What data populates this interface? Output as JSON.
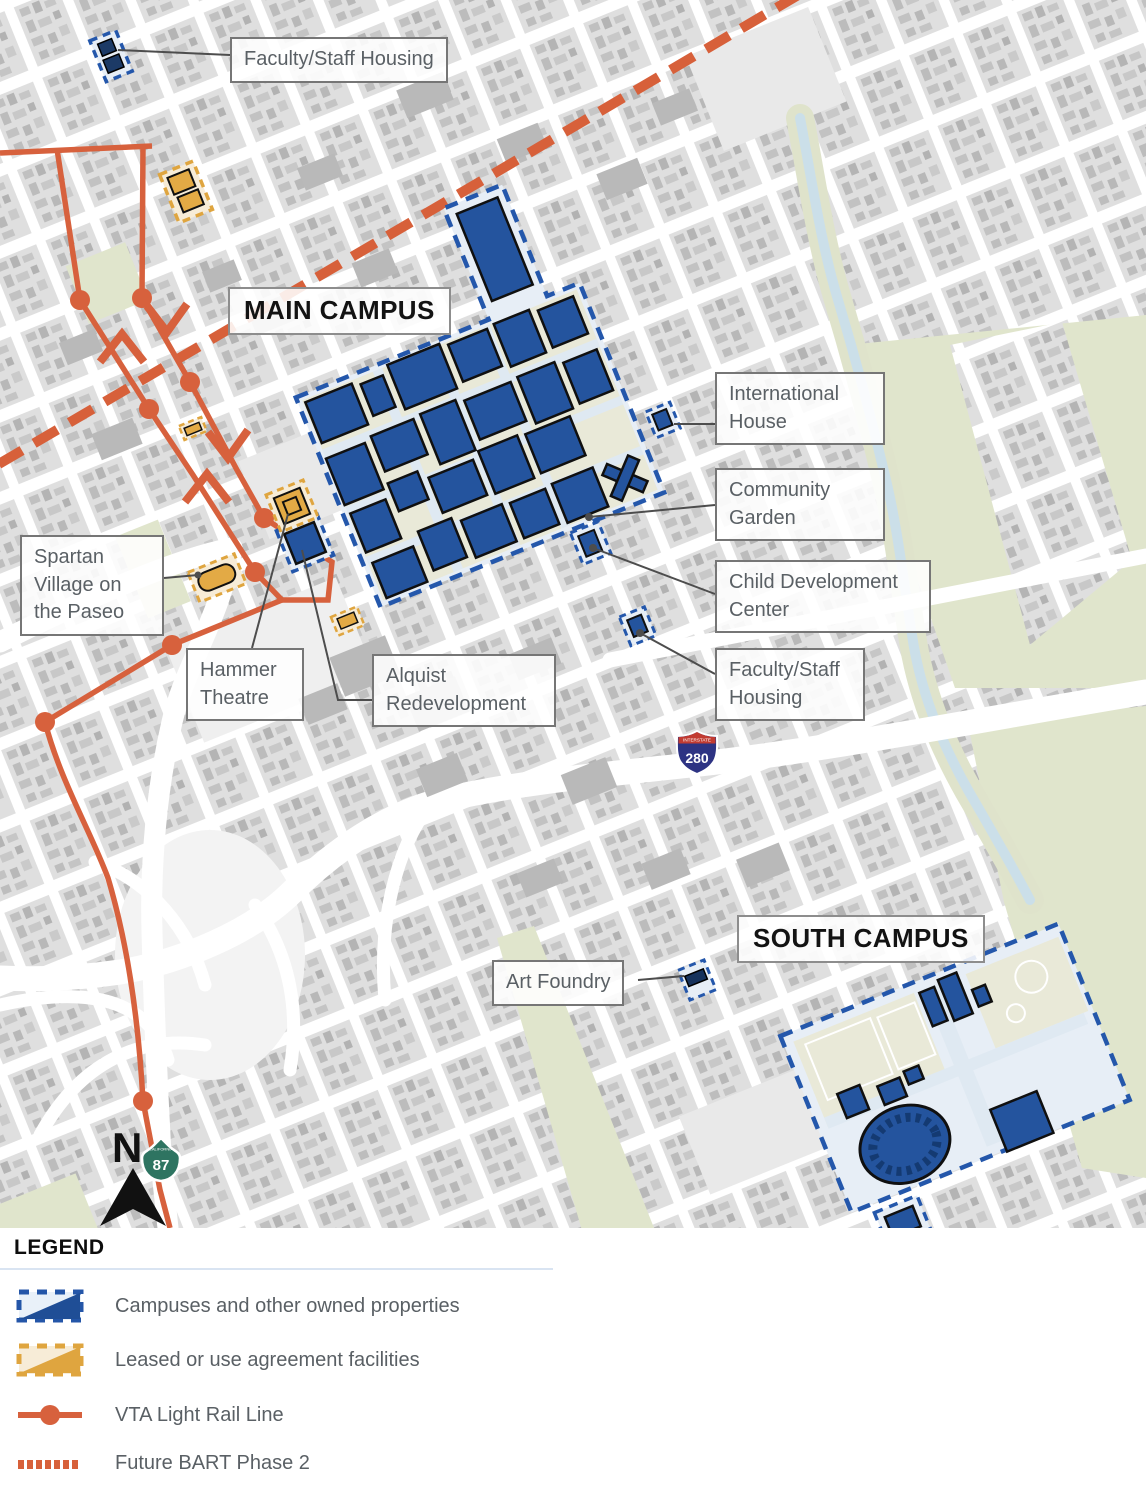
{
  "map": {
    "labels": [
      {
        "id": "faculty-staff-housing-north",
        "text": "Faculty/Staff Housing"
      },
      {
        "id": "main-campus",
        "text": "MAIN CAMPUS"
      },
      {
        "id": "international-house",
        "text": "International House"
      },
      {
        "id": "community-garden",
        "text": "Community Garden"
      },
      {
        "id": "child-development-center",
        "text": "Child Development Center"
      },
      {
        "id": "faculty-staff-housing-south",
        "text": "Faculty/Staff Housing"
      },
      {
        "id": "spartan-village",
        "text": "Spartan Village on the Paseo"
      },
      {
        "id": "hammer-theatre",
        "text": "Hammer Theatre"
      },
      {
        "id": "alquist-redevelopment",
        "text": "Alquist Redevelopment"
      },
      {
        "id": "south-campus",
        "text": "SOUTH CAMPUS"
      },
      {
        "id": "art-foundry",
        "text": "Art Foundry"
      }
    ],
    "shields": {
      "interstate_280": {
        "top_text": "INTERSTATE",
        "number": "280"
      },
      "ca_87": {
        "top_text": "CALIFORNIA",
        "number": "87"
      }
    },
    "north_arrow": {
      "label": "N"
    }
  },
  "legend": {
    "heading": "LEGEND",
    "items": [
      {
        "id": "owned",
        "label": "Campuses and other owned properties"
      },
      {
        "id": "leased",
        "label": "Leased or use agreement facilities"
      },
      {
        "id": "vta",
        "label": "VTA Light Rail Line"
      },
      {
        "id": "bart",
        "label": "Future BART Phase 2"
      }
    ]
  },
  "colors": {
    "owned_fill": "#24549e",
    "owned_border": "#2457ab",
    "owned_light": "#e7eef6",
    "leased_fill": "#e3aa45",
    "leased_cream": "#f7ecd7",
    "leased_border": "#dfa53f",
    "vta_line": "#d7613d",
    "bart_line": "#d7603a",
    "park_green": "#e0e5cc",
    "creek_blue": "#cbdfe9",
    "label_text": "#5a6065"
  }
}
